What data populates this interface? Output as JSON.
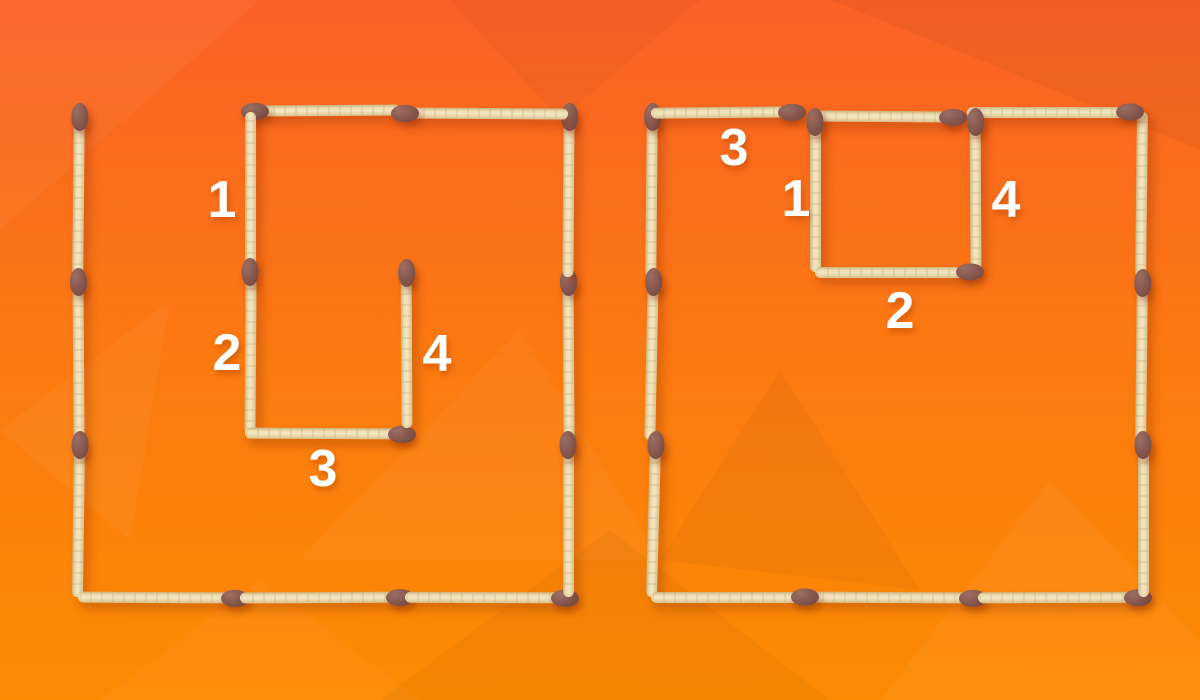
{
  "background": {
    "top_color": "#fa6126",
    "mid_color": "#fb7a10",
    "bottom_color": "#fc8b04"
  },
  "match_style": {
    "stick_light": "#f3e6c0",
    "stick_dark": "#cdb37f",
    "head_light": "#9c6f63",
    "head_mid": "#885a51",
    "head_dark": "#6d423c",
    "shadow": "rgba(140,45,0,0.30)"
  },
  "label_color": "#ffffff",
  "figures": [
    {
      "name": "left-figure",
      "matches": [
        {
          "x1": 78,
          "y1": 112,
          "x2": 78,
          "y2": 277,
          "head": "start",
          "r": 0.6
        },
        {
          "x1": 78,
          "y1": 277,
          "x2": 78,
          "y2": 440,
          "head": "start",
          "r": -0.4
        },
        {
          "x1": 78,
          "y1": 440,
          "x2": 78,
          "y2": 597,
          "head": "start",
          "r": 0.8
        },
        {
          "x1": 78,
          "y1": 597,
          "x2": 240,
          "y2": 597,
          "head": "end",
          "r": 0.3
        },
        {
          "x1": 240,
          "y1": 597,
          "x2": 405,
          "y2": 597,
          "head": "end",
          "r": -0.3
        },
        {
          "x1": 405,
          "y1": 597,
          "x2": 570,
          "y2": 597,
          "head": "end",
          "r": 0.2
        },
        {
          "x1": 568,
          "y1": 440,
          "x2": 568,
          "y2": 597,
          "head": "start",
          "r": 0
        },
        {
          "x1": 568,
          "y1": 277,
          "x2": 568,
          "y2": 440,
          "head": "start",
          "r": -0.4
        },
        {
          "x1": 568,
          "y1": 112,
          "x2": 568,
          "y2": 277,
          "head": "start",
          "r": 0.4
        },
        {
          "x1": 250,
          "y1": 110,
          "x2": 400,
          "y2": 110,
          "head": "start",
          "r": -0.4
        },
        {
          "x1": 400,
          "y1": 113,
          "x2": 568,
          "y2": 113,
          "head": "start",
          "r": 0.4
        },
        {
          "x1": 250,
          "y1": 112,
          "x2": 250,
          "y2": 277,
          "head": "end",
          "r": 0
        },
        {
          "x1": 250,
          "y1": 277,
          "x2": 250,
          "y2": 434,
          "head": "none",
          "r": 0.4
        },
        {
          "x1": 245,
          "y1": 433,
          "x2": 407,
          "y2": 433,
          "head": "end",
          "r": 0.3
        },
        {
          "x1": 406,
          "y1": 268,
          "x2": 406,
          "y2": 428,
          "head": "start",
          "r": -0.3
        }
      ],
      "labels": [
        {
          "text": "1",
          "x": 222,
          "y": 200
        },
        {
          "text": "2",
          "x": 227,
          "y": 353
        },
        {
          "text": "3",
          "x": 323,
          "y": 469
        },
        {
          "text": "4",
          "x": 437,
          "y": 354
        }
      ]
    },
    {
      "name": "right-figure",
      "matches": [
        {
          "x1": 651,
          "y1": 112,
          "x2": 651,
          "y2": 277,
          "head": "start",
          "r": 0.5
        },
        {
          "x1": 651,
          "y1": 277,
          "x2": 651,
          "y2": 440,
          "head": "start",
          "r": 1.2
        },
        {
          "x1": 653,
          "y1": 440,
          "x2": 653,
          "y2": 597,
          "head": "start",
          "r": 1.5
        },
        {
          "x1": 651,
          "y1": 597,
          "x2": 810,
          "y2": 597,
          "head": "end",
          "r": 0
        },
        {
          "x1": 810,
          "y1": 597,
          "x2": 978,
          "y2": 597,
          "head": "end",
          "r": 0.3
        },
        {
          "x1": 978,
          "y1": 597,
          "x2": 1143,
          "y2": 597,
          "head": "end",
          "r": -0.2
        },
        {
          "x1": 1141,
          "y1": 112,
          "x2": 1141,
          "y2": 278,
          "head": "none",
          "r": 0.6
        },
        {
          "x1": 1141,
          "y1": 278,
          "x2": 1141,
          "y2": 440,
          "head": "start",
          "r": 0.6
        },
        {
          "x1": 1143,
          "y1": 440,
          "x2": 1143,
          "y2": 597,
          "head": "start",
          "r": 0
        },
        {
          "x1": 651,
          "y1": 112,
          "x2": 797,
          "y2": 112,
          "head": "end",
          "r": -0.5
        },
        {
          "x1": 812,
          "y1": 116,
          "x2": 958,
          "y2": 116,
          "head": "end",
          "r": 0.4
        },
        {
          "x1": 967,
          "y1": 112,
          "x2": 1135,
          "y2": 112,
          "head": "end",
          "r": 0
        },
        {
          "x1": 815,
          "y1": 117,
          "x2": 815,
          "y2": 272,
          "head": "start",
          "r": 0
        },
        {
          "x1": 975,
          "y1": 117,
          "x2": 975,
          "y2": 272,
          "head": "start",
          "r": -0.3
        },
        {
          "x1": 815,
          "y1": 272,
          "x2": 975,
          "y2": 272,
          "head": "end",
          "r": 0
        }
      ],
      "labels": [
        {
          "text": "3",
          "x": 734,
          "y": 148
        },
        {
          "text": "1",
          "x": 796,
          "y": 199
        },
        {
          "text": "4",
          "x": 1006,
          "y": 200
        },
        {
          "text": "2",
          "x": 900,
          "y": 311
        }
      ]
    }
  ]
}
